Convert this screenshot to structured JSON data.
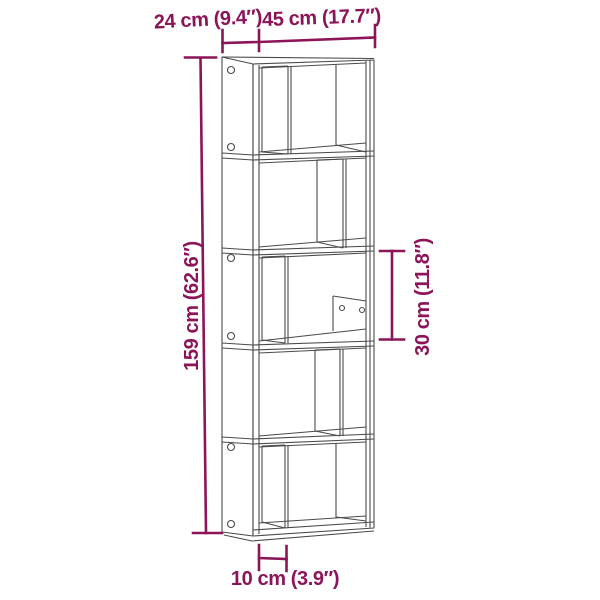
{
  "page": {
    "background": "#ffffff"
  },
  "diagram": {
    "subject": "bookcase-5-tier-line-drawing",
    "accent_color": "#8B1558",
    "line_color": "#4A4A4A",
    "labels": {
      "depth": "24 cm (9.4″)",
      "width": "45 cm (17.7″)",
      "height": "159 cm (62.6″)",
      "shelf_height": "30 cm (11.8″)",
      "divider_offset": "10 cm (3.9″)"
    }
  }
}
